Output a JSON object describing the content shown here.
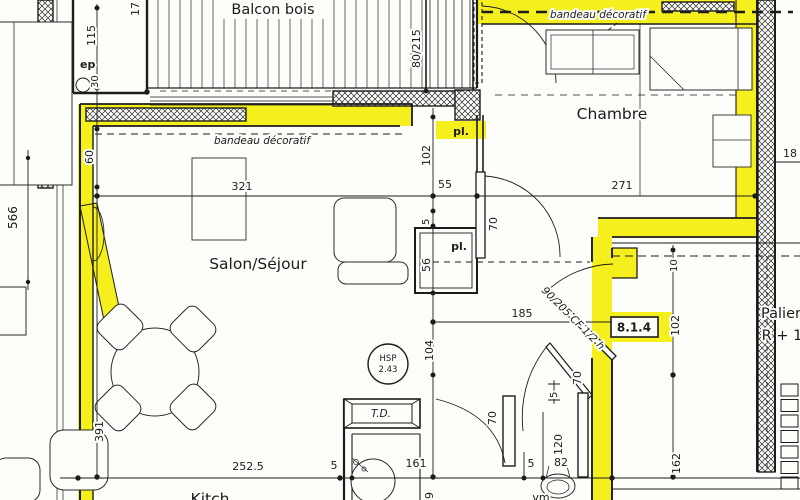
{
  "plan": {
    "rooms": {
      "balcony": "Balcon bois",
      "bedroom": "Chambre",
      "living": "Salon/Séjour",
      "landing_line1": "Palier",
      "landing_line2": "R + 1",
      "kitchen_partial": "Kitch"
    },
    "annotations": {
      "band_living": "bandeau décoratif",
      "band_bedroom": "bandeau décoratif",
      "entry_door_spec": "90/205 CF 1/2 h",
      "window_spec": "80/215",
      "ref_code": "8.1.4",
      "ceiling_height_line1": "HSP",
      "ceiling_height_line2": "2.43",
      "cable_box": "T.D.",
      "vent": "vm",
      "wall_thickness": "ep",
      "closet_top": "pl.",
      "closet_mid": "pl."
    },
    "dimensions": {
      "d17": "17",
      "d115": "115",
      "d30": "30",
      "d60": "60",
      "d566": "566",
      "d391": "391",
      "d321": "321",
      "d102_closet": "102",
      "d55": "55",
      "d5_closet": "5",
      "d56": "56",
      "d70_bedroom_door": "70",
      "d271": "271",
      "d185": "185",
      "d104": "104",
      "d102_landing": "102",
      "d10": "10",
      "d162": "162",
      "d18": "18",
      "d252_5": "252.5",
      "d5_a": "5",
      "d161": "161",
      "d5_b": "5",
      "d82": "82",
      "d120": "120",
      "d70_bath_door": "70",
      "d70_wc_door": "70",
      "d5_c": "5",
      "d9": "9"
    },
    "colors": {
      "wall_highlight": "#f5ef1d",
      "paper": "#fdfdfa",
      "ink": "#1c1c1c"
    }
  }
}
